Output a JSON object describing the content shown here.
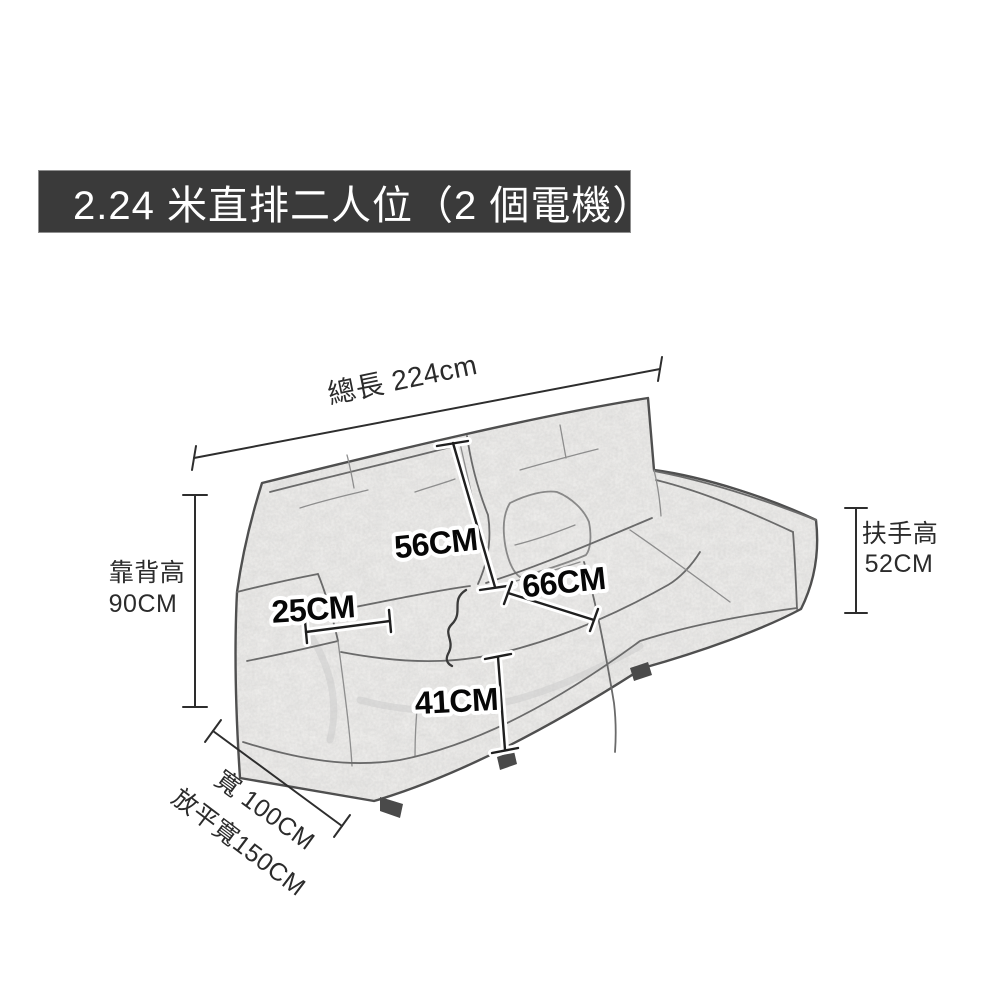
{
  "page": {
    "background_color": "#ffffff"
  },
  "banner": {
    "text": "2.24 米直排二人位（2 個電機）",
    "bg_color": "#3a3a3a",
    "text_color": "#ffffff"
  },
  "diagram": {
    "subject": "two-seat recliner sofa dimension sketch",
    "dimensions": {
      "total_length": {
        "label": "總長 224cm"
      },
      "backrest_height": {
        "line1": "靠背高",
        "line2": "90CM"
      },
      "armrest_height": {
        "line1": "扶手高",
        "line2": "52CM"
      },
      "width": {
        "label": "寬 100CM"
      },
      "flat_width": {
        "label": "放平寬150CM"
      },
      "backrest_panel": {
        "label": "56CM"
      },
      "seat_depth": {
        "label": "66CM"
      },
      "armrest_width": {
        "label": "25CM"
      },
      "seat_height": {
        "label": "41CM"
      }
    },
    "colors": {
      "dimension_line": "#2d2d2d",
      "sketch_line": "#4f4f4f",
      "badge_text": "#070707",
      "badge_halo": "#ffffff"
    }
  }
}
